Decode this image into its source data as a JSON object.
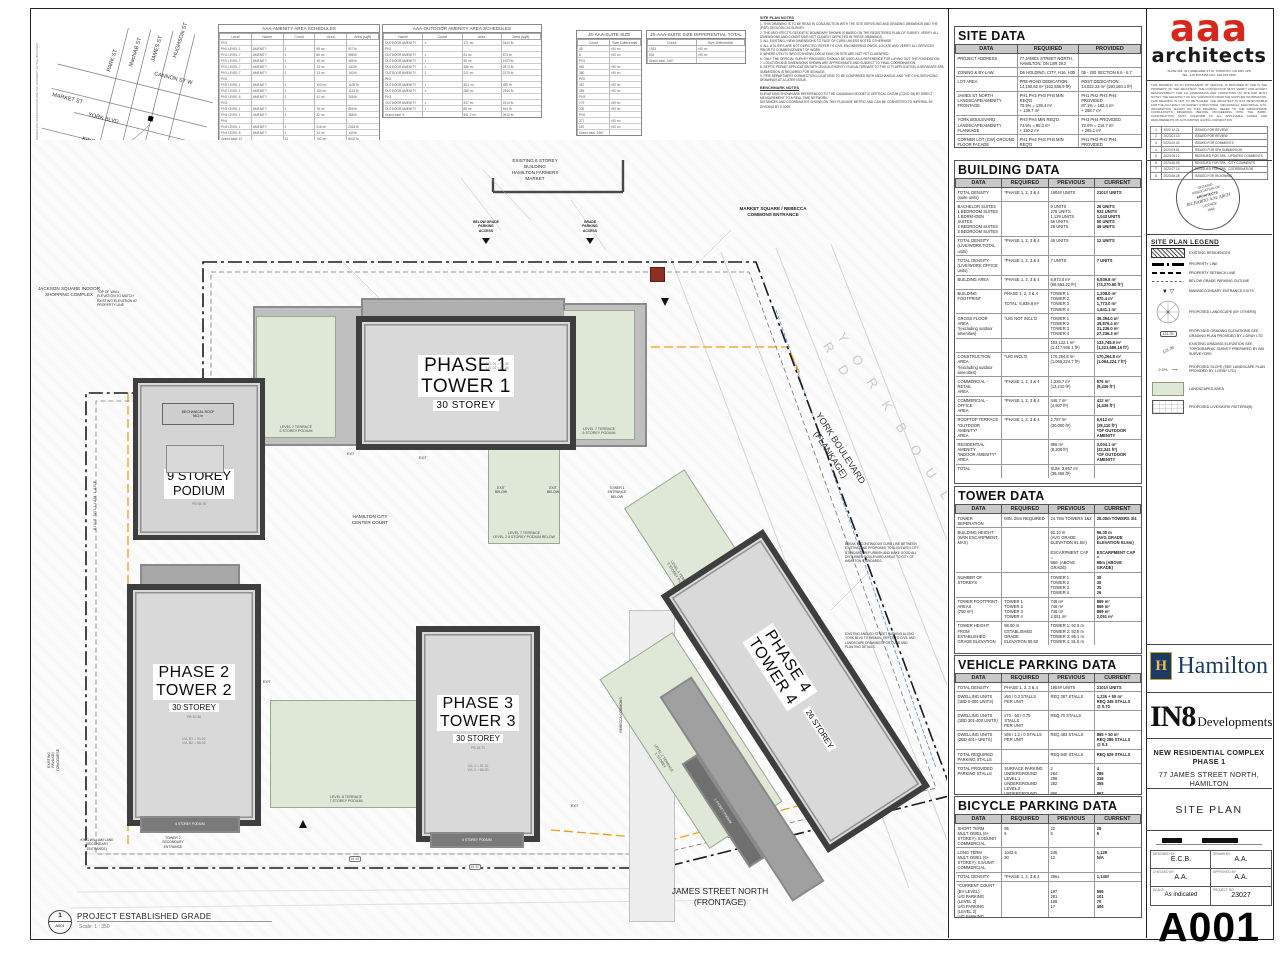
{
  "location_key": {
    "streets_vertical": [
      "PARK ST",
      "MacNAB ST",
      "JAMES ST",
      "HUGHSON ST"
    ],
    "cannon": "CANNON ST W",
    "market": "MARKET ST",
    "york": "YORK BLVD",
    "king": "KING ST E",
    "site_label": "SITE",
    "caption": "LOCATION KEY",
    "scale": "SCALE: NTS"
  },
  "schedules": {
    "amenity": {
      "title": "AAA-AMENITY AREA SCHEDULES",
      "headers": [
        "Level",
        "Name",
        "Count",
        "Area",
        "Area (sqft)"
      ],
      "rows": [
        [
          "PH1",
          "",
          "",
          "",
          ""
        ],
        [
          "PH1  LEVEL 1",
          "AMENITY",
          "1",
          "98 m²",
          "917 ft²"
        ],
        [
          "PH1  LEVEL 7",
          "AMENITY",
          "1",
          "86 m²",
          "988 ft²"
        ],
        [
          "PH1  LEVEL 7",
          "AMENITY",
          "1",
          "45 m²",
          "485 ft²"
        ],
        [
          "PH1  LEVEL 7",
          "AMENITY",
          "1",
          "13 m²",
          "140 ft²"
        ],
        [
          "PH1  LEVEL 7",
          "AMENITY",
          "1",
          "13 m²",
          "140 ft²"
        ],
        [
          "PH2",
          "",
          "",
          "",
          ""
        ],
        [
          "PH2  LEVEL 1",
          "AMENITY",
          "1",
          "103 m²",
          "1108 ft²"
        ],
        [
          "PH2  LEVEL 1",
          "AMENITY",
          "1",
          "104 m²",
          "1124 ft²"
        ],
        [
          "PH2  LEVEL 8",
          "AMENITY",
          "1",
          "41 m²",
          "345 ft²"
        ],
        [
          "PH3",
          "",
          "",
          "",
          ""
        ],
        [
          "PH3  LEVEL 1",
          "AMENITY",
          "1",
          "78 m²",
          "856 ft²"
        ],
        [
          "PH3  LEVEL 1",
          "AMENITY",
          "1",
          "32 m²",
          "358 ft²"
        ],
        [
          "PH4",
          "",
          "",
          "",
          ""
        ],
        [
          "PH4  LEVEL 1",
          "AMENITY",
          "1",
          "216 m²",
          "2326 ft²"
        ],
        [
          "PH4  LEVEL 8",
          "AMENITY",
          "1",
          "13 m²",
          "140 ft²"
        ],
        [
          "Grand total: 12",
          "",
          "12",
          "762 m²",
          "8402 ft²"
        ]
      ]
    },
    "outdoor": {
      "title": "AAA-OUTDOOR AMENITY AREA SCHEDULES",
      "headers": [
        "Name",
        "Count",
        "Area",
        "Area (sqft)"
      ],
      "rows": [
        [
          "OUTDOOR AMENITY",
          "1",
          "171 m²",
          "1841 ft²"
        ],
        [
          "PH1",
          "",
          "",
          ""
        ],
        [
          "OUTDOOR AMENITY",
          "1",
          "81 m²",
          "873 ft²"
        ],
        [
          "OUTDOOR AMENITY",
          "1",
          "95 m²",
          "1023 ft²"
        ],
        [
          "OUTDOOR AMENITY",
          "1",
          "286 m²",
          "2873 ft²"
        ],
        [
          "OUTDOOR AMENITY",
          "1",
          "221 m²",
          "2375 ft²"
        ],
        [
          "PH2",
          "",
          "",
          ""
        ],
        [
          "OUTDOOR AMENITY",
          "1",
          "45.1 m²",
          "485 ft²"
        ],
        [
          "OUTDOOR AMENITY",
          "1",
          "286 m²",
          "2944 ft²"
        ],
        [
          "PH3",
          "",
          "",
          ""
        ],
        [
          "OUTDOOR AMENITY",
          "1",
          "207 m²",
          "2213 ft²"
        ],
        [
          "OUTDOOR AMENITY",
          "1",
          "85 m²",
          "914 ft²"
        ],
        [
          "Grand total: 9",
          "",
          "561.2 m²",
          "2612 ft²"
        ]
      ]
    },
    "suite_size": {
      "title": "JS-AAA-SUITE SIZE",
      "headers": [
        "Count",
        "Size Differential"
      ],
      "rows": [
        [
          "39",
          "<90 m²"
        ],
        [
          "8",
          ">90 m²"
        ],
        [
          "PH1",
          ""
        ],
        [
          "462",
          "<90 m²"
        ],
        [
          "380",
          ">90 m²"
        ],
        [
          "PH2",
          ""
        ],
        [
          "367",
          "<90 m²"
        ],
        [
          "359",
          ">90 m²"
        ],
        [
          "PH3",
          ""
        ],
        [
          "179",
          "<90 m²"
        ],
        [
          "209",
          ">90 m²"
        ],
        [
          "PH4",
          ""
        ],
        [
          "277",
          "<90 m²"
        ],
        [
          "187",
          ">90 m²"
        ],
        [
          "Grand total: 2467",
          ""
        ]
      ]
    },
    "suite_diff": {
      "title": "JS-AAA-SUITE SIZE DIFFERENTIAL  TOTAL",
      "headers": [
        "Count",
        "Size Differential"
      ],
      "rows": [
        [
          "1933",
          "<90 m²"
        ],
        [
          "534",
          ">90 m²"
        ],
        [
          "Grand total: 2467",
          ""
        ]
      ]
    }
  },
  "notes": {
    "title": "SITE PLAN NOTES",
    "lines": [
      "1. THIS DRAWING IS TO BE READ IN CONJUNCTION WITH THE SITE SERVICING AND GRADING DRAWINGS AND THE (PSR) GEOLOGICAL SURVEY.",
      "2. THE ARCHITECT'S GEODETIC BOUNDARY SHOWN IS BASED ON THE REGISTERED PLAN OF SURVEY. VERIFY ALL DIMENSIONS AND CONDITIONS NOT CLEARLY DEPICTED IN THESE DRAWINGS.",
      "3. ALL EXISTING / NEW DIMENSIONS TO FACE OF CURB UNLESS NOTED OTHERWISE.",
      "4. ALL UTILITIES ARE NOT DEPICTED. REFER TO CIVIL ENGINEERING DWGS. LOCATE AND VERIFY ALL SERVICES PRIOR TO COMMENCEMENT OF WORK.",
      "5. WHERE UTILITY INFO IS SHOWN, LOCATIONS ON SITE ARE NOT YET CLASSIFIED.",
      "6. ONLY THE OFFICIAL SURVEY PROVIDED SHOULD BE USED AS A REFERENCE FOR LAYING OUT THE FOUNDATION.",
      "7. LOCATION AND DIMENSIONS SHOWN ARE APPROXIMATE AND SUBJECT TO FINAL COORDINATION.",
      "8. SEPTIC PERMIT APPLICATION WITH 2049 AUTHORITY IS AN ALTERNATE TO THE CITY APPLICATION. A SEPARATE SPA SUBMISSION IS REQUIRED FOR SIGNAGE.",
      "9. FIRE DEPARTMENT CONNECTION LOCATIONS TO BE CONFIRMED WITH MECHANICAL AND THE CIVIL SERVICING DRAWINGS AT A LATER ISSUE."
    ],
    "benchmark_title": "BENCHMARK NOTES",
    "benchmark_lines": [
      "ELEVATIONS SHOWN ARE REFERENCED TO THE CANADIAN GEODETIC VERTICAL DATUM (CGVD 28) BY DIRECT MEASUREMENT TO A REAL TIME NETWORK.",
      "DISTANCES AND COORDINATES SHOWN ON THIS PLAN ARE METRIC AND CAN BE CONVERTED TO IMPERIAL BY DIVIDING BY 0.3048"
    ]
  },
  "site_data": {
    "title": "SITE DATA",
    "headers": [
      "DATA",
      "REQUIRED",
      "PROVIDED"
    ],
    "rows": [
      [
        "PROJECT ADDRESS",
        "77 JAMES STREET NORTH,  HAMILTON, ON L8R 2K3",
        ""
      ],
      [
        "ZONING & BY-LAW",
        "D6 HOLDING, CITY, H16, H35",
        "05 - 200 SECTION 6.6 - 6.7"
      ],
      [
        "LOT AREA",
        "PRE-ROAD DEDICATION:\n14,190.62 m² (152,836.9 ft²)",
        "POST DEDICATION:\n14,022.23 m² (150,160.1 ft²)"
      ],
      [
        "JAMES ST NORTH\nLANDSCAPE/AMENITY FRONTAGE",
        "PH1 PH2 PH3 PH4 MIN REQ'D\n70.5%   = 139.4 m²\n+ 139.7 m²",
        "PH1 PH2 PH3 PH4 PROVIDED\n87.1%   = 182.4 m²\n+ 258.7 m²"
      ],
      [
        "YORK BOULEVARD\nLANDSCAPE/AMENITY FLANKAGE",
        "PH3 PH4 MIN REQ'D\n74.5%   =  88.3 m²\n+ 110.2 m²",
        "PH3 PH4 PROVIDED\n72.0%   = 216.7 m²\n+ 265.1 m²"
      ],
      [
        "CORNER LOT (GW) GROUND\nFLOOR FACADE\nLANDSCAPE/AMENITY FLANKAGE",
        "PH1 PH2 PH3 PH4 MIN REQ'D\n60%   = 216.1 m²\n+ 139.5 m²",
        "PH1 PH2 PH3 PH4 PROVIDED\n70.0%   = 218.1 m²\n+ 265.7 m²"
      ]
    ]
  },
  "building_data": {
    "title": "BUILDING DATA",
    "headers": [
      "DATA",
      "REQUIRED",
      "PREVIOUS",
      "CURRENT"
    ],
    "rows": [
      [
        "TOTAL DENSITY (suite units)",
        "*PHASE 1, 2, 3 & 4",
        "1904# UNITS",
        "2101# UNITS"
      ],
      [
        "BACHELOR SUITES\n1 BEDROOM SUITES\n1 BDRM+DEN SUITES\n2 BEDROOM SUITES\n3 BEDROOM SUITES",
        "",
        "9 UNITS\n276 UNITS\n1,129 UNITS\n56 UNITS\n28 UNITS",
        "26 UNITS\n933 UNITS\n1,043 UNITS\n50 UNITS\n49 UNITS"
      ],
      [
        "TOTAL DENSITY\n(LIVE/WORK TOTAL units)",
        "*PHASE 1, 2, 3 & 4",
        "46 UNITS",
        "12 UNITS"
      ],
      [
        "TOTAL DENSITY\n(LIVE/WORK OFFICE units)",
        "*PHASE 1, 2, 3 & 4",
        "7 UNITS",
        "7 UNITS"
      ],
      [
        "BUILDING AREA",
        "*PHASE 1, 2, 3 & 4",
        "6,973.0 m²\n(66,553.22 ft²)",
        "6,939.8 m²\n(74,270.60 ft²)"
      ],
      [
        "BUILDING FOOTPRINT",
        "PHASE 1, 2, 3 & 4\n\nTOTAL: 6,939.8 m²",
        "TOWER 1\nTOWER 2\nTOWER 3\nTOWER 4",
        "1,208.0 m²\n870.4 m²\n1,773.0 m²\n1,841.1 m²"
      ],
      [
        "GROSS FLOOR AREA\n*(excluding outdoor\namenities)",
        "*U/G NOT INCL'D",
        "TOWER 1\nTOWER 2\nTOWER 3\nTOWER 4",
        "39,394.0 m²\n39,876.4 m²\n31,236.0 m²\n27,236.3 m²"
      ],
      [
        "",
        "",
        "103,132.1 m²\n(1,417,936.1 ft²)",
        "133,745.9 m²\n(1,221,586.16 ft²)"
      ],
      [
        "CONSTRUCTION AREA\n*(excluding outdoor\namenities)",
        "*U/G INCL'D",
        "170,264.8 m²\n(1,069,224.7 ft²)",
        "170,264.8 m²\n(1,064,224.7 ft²)"
      ],
      [
        "COMMERCIAL - RETAIL\nAREA",
        "*PHASE 1, 2, 3 & 4",
        "1,226.7 m²\n(13,210 ft²)",
        "876 m²\n(9,436 ft²)"
      ],
      [
        "COMMERCIAL - OFFICE\nAREA",
        "*PHASE 1, 2, 3 & 4",
        "446.7 m²\n(4,807 ft²)",
        "412 m²\n(4,436 ft²)"
      ],
      [
        "ROOFTOP TERRACE\n*OUTDOOR AMENITY*\nAREA",
        "*PHASE 1, 2, 3 & 4",
        "2,787 m²\n(30,000 ft²)",
        "5,612 m²\n(28,110 ft²)\n*OF OUTDOOR\nAMENITY"
      ],
      [
        "RESIDENTIAL AMENITY\n*INDOOR AMENITY*\nAREA",
        "",
        "856 m²\n(9,208 ft²)",
        "3,004.1 m²\n(32,341 ft²)\n*OF OUTDOOR\nAMENITY"
      ],
      [
        "TOTAL",
        "",
        "SUM: 3,857 m²\n(39,466 ft²)",
        ""
      ]
    ]
  },
  "tower_data": {
    "title": "TOWER DATA",
    "headers": [
      "DATA",
      "REQUIRED",
      "PREVIOUS",
      "CURRENT"
    ],
    "rows": [
      [
        "TOWER SEPERATION",
        "MIN. 25m REQUIRED",
        "24.78m TOWERS 1&2",
        "25.00m TOWERS 3/4"
      ],
      [
        "BUILDING HEIGHT\n(W/IN ESCARPMENT MAX)",
        "",
        "92.10 m\n(AVG GRADE ELEVATION 91.5m)\n\nESCARPMENT CAP =\n98m (ABOVE GRADE)",
        "96.30 m\n(AVG GRADE ELEVATION 91.5m)\n\nESCARPMENT CAP =\n98m (ABOVE GRADE)"
      ],
      [
        "NUMBER OF STOREYS",
        "",
        "TOWER 1\nTOWER 2\nTOWER 3\nTOWER 4",
        "30\n30\n30\n26"
      ],
      [
        "TOWER FOOTPRINT\nAREAS\n(750 m²)",
        "TOWER 1\nTOWER 2\nTOWER 3\nTOWER 4",
        "748 m²\n748 m²\n746 m²\n2,051 m²",
        "869 m²\n869 m²\n869 m²\n2,051 m²"
      ],
      [
        "TOWER HEIGHT\nFROM\nESTABLISHED\nGRADE ELEVATION",
        "98.00 m\nESTABLISHED GRADE\nELEVATION 90.50",
        "TOWER 1:   92.9 m\nTOWER 2:   92.9 m\nTOWER 3:   95.1 m\nTOWER 4:   91.5 m",
        ""
      ]
    ]
  },
  "vehicle_parking": {
    "title": "VEHICLE PARKING DATA",
    "headers": [
      "DATA",
      "REQUIRED",
      "PREVIOUS",
      "CURRENT"
    ],
    "rows": [
      [
        "TOTAL DENSITY",
        "PHASE 1, 2, 3 & 4",
        "1904# UNITS",
        "2101# UNITS"
      ],
      [
        "DWELLING UNITS\n(1BD 0-300 UNITS)",
        "x50 / 0.3 STALLS\nPER UNIT",
        "REQ 387 STALLS",
        "1,226 + 50 m²\nREQ 345 STALLS\n@ 0.70"
      ],
      [
        "DWELLING UNITS\n(1BD 301-400 UNITS)",
        "x70 - 50 / 0.75 STALLS\nPER UNIT",
        "REQ 70 STALLS",
        ""
      ],
      [
        "DWELLING UNITS\n(2BD 401+ UNITS)",
        "x86 / 1.2 / 0 STALLS\nPER UNIT",
        "REQ 483 STALLS",
        "865 + 50 m²\nREQ 286 STALLS\n@ 0.3"
      ],
      [
        "TOTAL REQUIRED\nPARKING STALLS",
        "",
        "REQ 940 STALLS",
        "REQ 629 STALLS"
      ],
      [
        "TOTAL PROVIDED\nPARKING STALLS",
        "SURFACE PARKING\nUNDERGROUND LEVEL 1\nUNDERGROUND LEVEL 2\nUNDERGROUND LEVEL 3",
        "2\n284\n298\n282\n\n866",
        "4\n285\n318\n355\n\n962"
      ]
    ]
  },
  "bicycle_parking": {
    "title": "BICYCLE PARKING DATA",
    "headers": [
      "DATA",
      "REQUIRED",
      "PREVIOUS",
      "CURRENT"
    ],
    "rows": [
      [
        "SHORT TERM\nMULT. DWEL (6+ STOREY): 0.05/UNIT\nCOMMERCIAL",
        "95\n6",
        "22\n5",
        "29\n5"
      ],
      [
        "LONG TERM\nMULT. DWEL (6+ STOREY): 0.5/UNIT\nCOMMERCIAL",
        "1042.5\n30",
        "246\n12",
        "1,129\nN/A"
      ],
      [
        "TOTAL DENSITY",
        "*PHASE 1, 2, 3 & 4",
        "286±",
        "1,140#"
      ],
      [
        "*CURRENT COUNT (BY LEVEL)\nU/G PARKING (LEVEL 3)\nU/G PARKING (LEVEL 2)\nU/G PARKING (LEVEL 1)\nGROUND (LEVEL 1)",
        "",
        "\n197\n281\n188\n17",
        "\n565\n101\n70\n404"
      ],
      [
        "TOTAL PROVIDED",
        "*PHASE 1, 2, 3 & 4",
        "286±",
        "1,140#"
      ]
    ]
  },
  "titleblock": {
    "firm_logo": "aaa",
    "firm_sub": "architects",
    "firm_address": "SUITE 501, 317 ADELAIDE ST W, TORONTO, ON M5V 1P9\nTEL: 416 979 5155   FAX: 416 979 5156",
    "disclaimer": "THIS DRAWING, AS AN INSTRUMENT OF SERVICE, IS PROVIDED BY AND IS THE PROPERTY OF THE ARCHITECT. THE CONTRACTOR MUST VERIFY AND ACCEPT RESPONSIBILITY FOR ALL DIMENSIONS AND CONDITIONS ON SITE AND MUST NOTIFY THE ARCHITECT OF ANY VARIATIONS FROM THE SUPPLIED INFORMATION. THIS DRAWING IS NOT TO BE SCALED. THE ARCHITECT IS NOT RESPONSIBLE FOR THE ACCURACY OF SURVEY, STRUCTURAL, MECHANICAL, ELECTRICAL, ETC. INFORMATION SHOWN ON THIS DRAWING. REFER TO THE APPROPRIATE CONSULTANT'S DRAWINGS BEFORE PROCEEDING WITH THE WORK. CONSTRUCTION MUST CONFORM TO ALL APPLICABLE CODES AND REQUIREMENTS OF AUTHORITIES HAVING JURISDICTION.",
    "revisions": {
      "rows": [
        [
          "1",
          "2022.12.21",
          "ISSUED FOR REVIEW"
        ],
        [
          "2",
          "2023.01.13",
          "ISSUED FOR REVIEW"
        ],
        [
          "3",
          "2023.02.03",
          "ISSUED FOR COMMENTS"
        ],
        [
          "4",
          "2023.03.01",
          "ISSUED FOR SPA SUBMISSION"
        ],
        [
          "5",
          "2023.05.12",
          "REISSUED FOR SPA - UPDATED COMMENTS"
        ],
        [
          "6",
          "2023.06.09",
          "REISSUED FOR SPA - CITY COMMENTS"
        ],
        [
          "7",
          "2023.07.14",
          "REISSUED FOR SPA - COORDINATION"
        ],
        [
          "8",
          "2023.08.25",
          "ISSUED FOR REZONING"
        ]
      ]
    },
    "seal": {
      "l1": "ONTARIO",
      "l2": "ASSOCIATION OF",
      "l3": "ARCHITECTS",
      "l4": "RICHARDO A.M. ARCH",
      "l5": "LICENCE",
      "l6": "7946"
    },
    "legend": {
      "title": "SITE PLAN LEGEND",
      "items": [
        "EXISTING RESIDENCES",
        "PROPERTY LINE",
        "PROPERTY SETBACK LINE",
        "BELOW GRADE PARKING OUTLINE",
        "MAIN/SECONDARY ENTRANCE EXITS",
        "PROPOSED LANDSCAPE (BY OTHERS)",
        "PROPOSED GRADING ELEVATIONS SEE GRADING PLAN PROVIDED BY J.GRAY LTD",
        "EXISTING GRADING ELEVATION SEE TOPOGRAPHIC SURVEY PREPARED BY BSI SURVEYORS",
        "PROPOSED SLOPE (SEE LANDSCAPE PLAN PROVIDED BY J.GRAY LTD)",
        "LANDSCAPED AREA",
        "PROPOSED LIVE/WORK PATTERN(S)"
      ],
      "tag_example": "121.35",
      "exgrade_example": "121.35",
      "slope_example": "2.0%"
    },
    "hamilton": "Hamilton",
    "hamilton_emblem": "H",
    "in8": "IN8",
    "in8_sub": "Developments",
    "project": "NEW RESIDENTIAL COMPLEX PHASE 1",
    "project_address": "77 JAMES STREET NORTH, HAMILTON",
    "sheet_title": "SITE PLAN",
    "credits": {
      "designed_label": "DESIGNED BY:",
      "designed": "E.C.B.",
      "drawn_label": "DRAWN BY:",
      "drawn": "A.A.",
      "checked_label": "CHECKED BY:",
      "checked": "A.A.",
      "approved_label": "APPROVED BY:",
      "approved": "A.A.",
      "scale_label": "SCALE:",
      "scale": "As indicated",
      "project_label": "PROJECT NO:",
      "project_no": "23027"
    },
    "sheet_no": "A001"
  },
  "plan": {
    "jackson": "JACKSON SQUARE INDOOR\nSHOPPING COMPLEX",
    "top_of_wall": "TOP OF WALL\nELEVATION TO MATCH\nEXISTING ELEVATION AT\nPROPERTY LINE",
    "existing_pavilion": "EXISTING\nPAVILION\nCONCOURSE",
    "king_william": "KING WILLIAM LANE",
    "kw_secondary": "KING WILLIAM LANE\n(SECONDARY\nENTRANCE)",
    "tower2_secondary": "TOWER 2\nSECONDARY\nENTRANCE",
    "farmers_market": "EXISTING 6 STOREY\nBUILDING\nHAMILTON FARMERS\nMARKET",
    "market_square": "MARKET SQUARE / REBECCA\nCOMMONS ENTRANCE",
    "below_grade": "BELOW GRADE\nPARKING\nACCESS",
    "grade_parking": "GRADE\nPARKING\nACCESS",
    "hamilton_court": "HAMILTON CITY\nCENTER COURT",
    "rebecca": "REBECCA COMMONS",
    "james_street": "JAMES STREET NORTH\n(FRONTAGE)",
    "york_blvd": "YORK BOULEVARD\n(FLANKAGE)",
    "york_ghost": "Y O R K   B O U L E V A R D",
    "phase1": "PHASE 1\nTOWER 1",
    "phase1_storey": "30 STOREY",
    "phase2": "PHASE 2\nTOWER 2",
    "phase2_storey": "30 STOREY",
    "phase3": "PHASE 3\nTOWER 3",
    "phase3_storey": "30 STOREY",
    "phase4": "PHASE 4\nTOWER 4",
    "phase4_storey": "26 STOREY",
    "podium": "9 STOREY\nPODIUM",
    "podium_pte": "PB 98.76",
    "mech_roof": "MECHANICAL ROOF\n98.2 m",
    "lvl_note1": "LVL 01 = 91.30\nLVL 02 = 86.80",
    "lvl_note2": "LVL B1 = 91.02\nLVL B2 = 86.02",
    "lvl_note3": "LVL 1 = 91.32\nLVL 2 = 86.00",
    "pte2": "PB 10.36",
    "pte3": "PB 16.71",
    "terr_t1_left": "LEVEL 7 TERRACE\n6 STOREY PODIUM",
    "terr_t1_right": "LEVEL 7 TERRACE\n6 STOREY PODIUM",
    "terr_t1_below": "LEVEL 7 TERRACE\nLEVEL 2 6 STOREY PODIUM BELOW",
    "terr_mid": "LEVEL 8 TERRACE\n7 STOREY PODIUM",
    "terr_t4_upper": "LEVEL 4 TERRACE\n3 STOREY PODIUM",
    "terr_t4_lower": "LEVEL 2 TERRACE\n1 STOREY",
    "pod_strip_1": "1 STOREY PODIUM",
    "pod_strip_2": "6 STOREY PODIUM",
    "pod_strip_3": "6 STOREY PODIUM",
    "tower1_entry": "TOWER 1\nENTRANCE\nBELOW",
    "exit_below_1": "EXIT\nBELOW",
    "exit_below_2": "EXIT\nBELOW",
    "exit_1": "EXIT",
    "exit_2": "EXIT",
    "exit_3": "EXIT",
    "exit_4": "EXIT",
    "tag_1": "91.45",
    "tag_2": "91.30",
    "note_r1": "BREAK IN CONTINUOUS CURB LINE BETWEEN EXISTING AND PROPOSED TO ALIGN WITH CITY STANDARD. REFURBISH AND MAKE GOOD ALL DISTURBED BOULEVARD AREAS TO CITY OF HAMILTON STANDARDS.",
    "note_r2": "EXISTING ANGLED STREET PARKING ALONG YORK BLVD TO REMAIN. REFER TO CIVIL AND LANDSCAPE DRAWINGS FOR CURB AND PLANTING DETAILS.",
    "established": "PROJECT ESTABLISHED GRADE",
    "established_scale": "Scale:  1 : 350",
    "callout_no": "1",
    "callout_sheet": "A001",
    "margin_note": "ALL DRAWINGS AND SPECIFICATIONS ARE THE PROPERTY OF THE ARCHITECT"
  }
}
